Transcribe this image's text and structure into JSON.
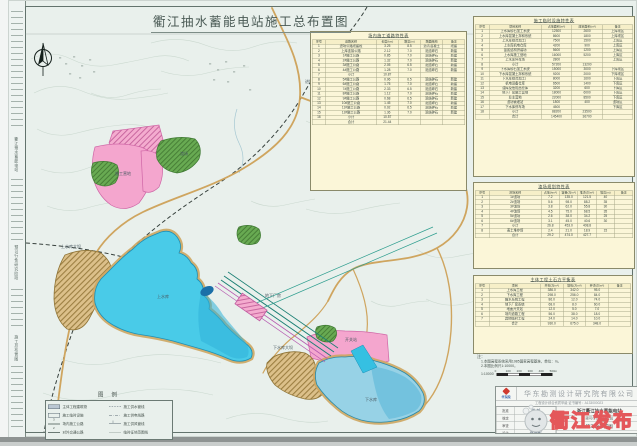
{
  "title": "衢江抽水蓄能电站施工总布置图",
  "watermark": {
    "text": "衢江发布"
  },
  "side_strip": {
    "texts": [
      "衢江抽水蓄能电站",
      "预可行性研究阶段",
      "施工总布置图"
    ]
  },
  "colors": {
    "paper": "#e9f0ec",
    "table_bg": "#fbf6d8",
    "upper_lake": "#49cbe8",
    "lower_lake": "#97d2e6",
    "pink_zone": "#f4a6ce",
    "green_zone": "#68aa52",
    "road": "#cfa55f",
    "tunnel": "#1b7f74",
    "watermark_red": "#e4575a"
  },
  "map_labels": [
    {
      "text": "上水库",
      "x": 148,
      "y": 293
    },
    {
      "text": "上水库大坝",
      "x": 52,
      "y": 243
    },
    {
      "text": "下水库",
      "x": 356,
      "y": 396
    },
    {
      "text": "下水库大坝",
      "x": 264,
      "y": 344
    },
    {
      "text": "地下厂房",
      "x": 256,
      "y": 292
    },
    {
      "text": "施工营地",
      "x": 106,
      "y": 170
    },
    {
      "text": "渣场",
      "x": 171,
      "y": 150
    },
    {
      "text": "进场公路",
      "x": 296,
      "y": 78
    },
    {
      "text": "开关站",
      "x": 336,
      "y": 336
    }
  ],
  "tables": {
    "road": {
      "title": "场内施工道路特性表",
      "headers": [
        "序号",
        "道路名称",
        "长度(km)",
        "路宽(m)",
        "路面结构",
        "备注"
      ],
      "rows": [
        [
          "1",
          "进场公路改建段",
          "3.25",
          "8.5",
          "沥青混凝土",
          "改建"
        ],
        [
          "2",
          "上库连接公路",
          "2.12",
          "7.0",
          "泥结碎石",
          "新建"
        ],
        [
          "3",
          "1#施工公路",
          "0.85",
          "7.0",
          "泥结碎石",
          "新建"
        ],
        [
          "4",
          "2#施工公路",
          "1.32",
          "7.0",
          "泥结碎石",
          "新建"
        ],
        [
          "5",
          "3#施工公路",
          "2.05",
          "6.5",
          "泥结碎石",
          "新建"
        ],
        [
          "6",
          "4#施工公路",
          "1.28",
          "7.0",
          "泥结碎石",
          "新建"
        ],
        [
          "7",
          "小计",
          "10.87",
          "",
          "",
          ""
        ],
        [
          "8",
          "5#施工公路",
          "0.96",
          "6.5",
          "泥结碎石",
          "新建"
        ],
        [
          "9",
          "6#施工公路",
          "1.75",
          "7.0",
          "泥结碎石",
          "新建"
        ],
        [
          "10",
          "7#施工公路",
          "2.33",
          "6.5",
          "泥结碎石",
          "新建"
        ],
        [
          "11",
          "8#施工公路",
          "1.12",
          "7.0",
          "泥结碎石",
          "新建"
        ],
        [
          "12",
          "9#施工公路",
          "0.68",
          "6.5",
          "泥结碎石",
          "新建"
        ],
        [
          "13",
          "10#施工公路",
          "1.45",
          "7.0",
          "泥结碎石",
          "新建"
        ],
        [
          "14",
          "11#施工公路",
          "0.92",
          "6.5",
          "泥结碎石",
          "新建"
        ],
        [
          "15",
          "12#施工公路",
          "1.36",
          "7.0",
          "泥结碎石",
          "新建"
        ],
        [
          "16",
          "小计",
          "10.57",
          "",
          "",
          ""
        ],
        [
          "",
          "合计",
          "21.44",
          "",
          "",
          ""
        ]
      ]
    },
    "facilities": {
      "title": "施工临时设施特性表",
      "headers": [
        "序号",
        "项目名称",
        "占地面积(m²)",
        "建筑面积(m²)",
        "备注"
      ],
      "rows": [
        [
          "1",
          "上水库砂石加工系统",
          "12500",
          "2600",
          "上库坝区"
        ],
        [
          "2",
          "上水库混凝土拌和系统",
          "8600",
          "1800",
          "上库坝区"
        ],
        [
          "3",
          "上水库综合加工厂",
          "7500",
          "1500",
          "上库区"
        ],
        [
          "4",
          "上水库机电仓库",
          "4200",
          "900",
          "上库区"
        ],
        [
          "5",
          "金属结构拼装场",
          "5600",
          "1200",
          "上库区"
        ],
        [
          "6",
          "上水库施工营地",
          "16000",
          "5200",
          "上库区"
        ],
        [
          "7",
          "上水库停车场",
          "2800",
          "",
          "上库区"
        ],
        [
          "8",
          "小计",
          "57200",
          "13200",
          ""
        ],
        [
          "9",
          "下水库砂石加工系统",
          "15000",
          "3000",
          "下库坝区"
        ],
        [
          "10",
          "下水库混凝土拌和系统",
          "9200",
          "2000",
          "下库坝区"
        ],
        [
          "11",
          "下水库综合加工厂",
          "8000",
          "1600",
          "下库区"
        ],
        [
          "12",
          "机电设备仓库",
          "6500",
          "1400",
          "下库区"
        ],
        [
          "13",
          "油库及危险品仓库",
          "3200",
          "600",
          "下库区"
        ],
        [
          "14",
          "地下厂房施工营地",
          "18000",
          "6000",
          "下库区"
        ],
        [
          "15",
          "业主营地",
          "22000",
          "8500",
          "下库区"
        ],
        [
          "16",
          "渣场管理站",
          "1800",
          "400",
          "渣场区"
        ],
        [
          "17",
          "下水库停车场",
          "4500",
          "",
          "下库区"
        ],
        [
          "18",
          "小计",
          "88200",
          "23500",
          ""
        ],
        [
          "",
          "合计",
          "145400",
          "36700",
          ""
        ]
      ]
    },
    "spoil": {
      "title": "渣场规划特性表",
      "headers": [
        "序号",
        "渣场名称",
        "占地(hm²)",
        "容量(万m³)",
        "堆渣(万m³)",
        "堆高(m)",
        "备注"
      ],
      "rows": [
        [
          "1",
          "1#渣场",
          "7.2",
          "135.0",
          "121.5",
          "40",
          ""
        ],
        [
          "2",
          "2#渣场",
          "5.6",
          "98.0",
          "88.2",
          "35",
          ""
        ],
        [
          "3",
          "3#渣场",
          "3.8",
          "62.0",
          "55.8",
          "30",
          ""
        ],
        [
          "4",
          "4#渣场",
          "4.5",
          "75.0",
          "68.5",
          "35",
          ""
        ],
        [
          "5",
          "5#渣场",
          "2.6",
          "38.0",
          "34.2",
          "25",
          ""
        ],
        [
          "6",
          "6#渣场",
          "3.1",
          "45.0",
          "40.6",
          "30",
          ""
        ],
        [
          "7",
          "小计",
          "26.8",
          "453.0",
          "408.8",
          "",
          ""
        ],
        [
          "8",
          "表土堆存场",
          "2.4",
          "21.0",
          "18.9",
          "15",
          ""
        ],
        [
          "",
          "合计",
          "29.2",
          "474.0",
          "427.7",
          "",
          ""
        ]
      ]
    },
    "earthwork": {
      "title": "主体工程土石方平衡表",
      "headers": [
        "序号",
        "项目",
        "开挖(万m³)",
        "填筑(万m³)",
        "弃渣(万m³)",
        "备注"
      ],
      "rows": [
        [
          "1",
          "上水库工程",
          "386.0",
          "342.0",
          "95.0",
          ""
        ],
        [
          "2",
          "下水库工程",
          "298.0",
          "256.0",
          "84.0",
          ""
        ],
        [
          "3",
          "输水系统工程",
          "86.0",
          "12.0",
          "74.0",
          ""
        ],
        [
          "4",
          "地下厂房系统",
          "68.0",
          "8.0",
          "60.0",
          ""
        ],
        [
          "5",
          "地面开关站",
          "12.0",
          "5.0",
          "7.0",
          ""
        ],
        [
          "6",
          "场内道路工程",
          "56.0",
          "38.0",
          "18.0",
          ""
        ],
        [
          "7",
          "其他临时工程",
          "24.0",
          "14.0",
          "10.0",
          ""
        ],
        [
          "",
          "合计",
          "930.0",
          "675.0",
          "348.0",
          ""
        ]
      ]
    }
  },
  "notes": {
    "label": "注：",
    "lines": [
      "1.本图高程系统采用1985国家高程基准，单位：m。",
      "2.本图比例尺1:10000。"
    ]
  },
  "scalebar": {
    "ratio": "1:10000",
    "ticks": [
      "0",
      "100",
      "200",
      "300",
      "400",
      "500m"
    ]
  },
  "legend": {
    "title": "图 例",
    "left": [
      {
        "type": "rect-solid",
        "label": "主体工程建筑物"
      },
      {
        "type": "rect-open",
        "label": "施工临时设施"
      },
      {
        "type": "road3",
        "label": "场内施工公路"
      },
      {
        "type": "road2",
        "label": "对外交通公路"
      }
    ],
    "right": [
      {
        "type": "dash2",
        "label": "施工供水管线"
      },
      {
        "type": "dashdot",
        "label": "施工供电线路"
      },
      {
        "type": "ticks",
        "label": "施工供风管线"
      },
      {
        "type": "thin",
        "label": "临时征地范围线"
      }
    ]
  },
  "titleblock": {
    "company": "华东勘测设计研究院有限公司",
    "cert": "工程设计综合资质甲级  证书编号：A133000023",
    "logo_text": "华东院",
    "signs": {
      "rows": [
        [
          "批准",
          "周 毅"
        ],
        [
          "核定",
          "吴 斌"
        ],
        [
          "审查",
          "全玲英"
        ],
        [
          "设计",
          "聂德彬"
        ]
      ]
    },
    "project": "浙江衢江抽水蓄能电站",
    "stage": "预可行性研究阶段",
    "drawing_title": "施工总布置图",
    "meta": [
      "比例 1:10000",
      "日期 2017.06",
      "图号 H3561K-SG-01"
    ]
  }
}
